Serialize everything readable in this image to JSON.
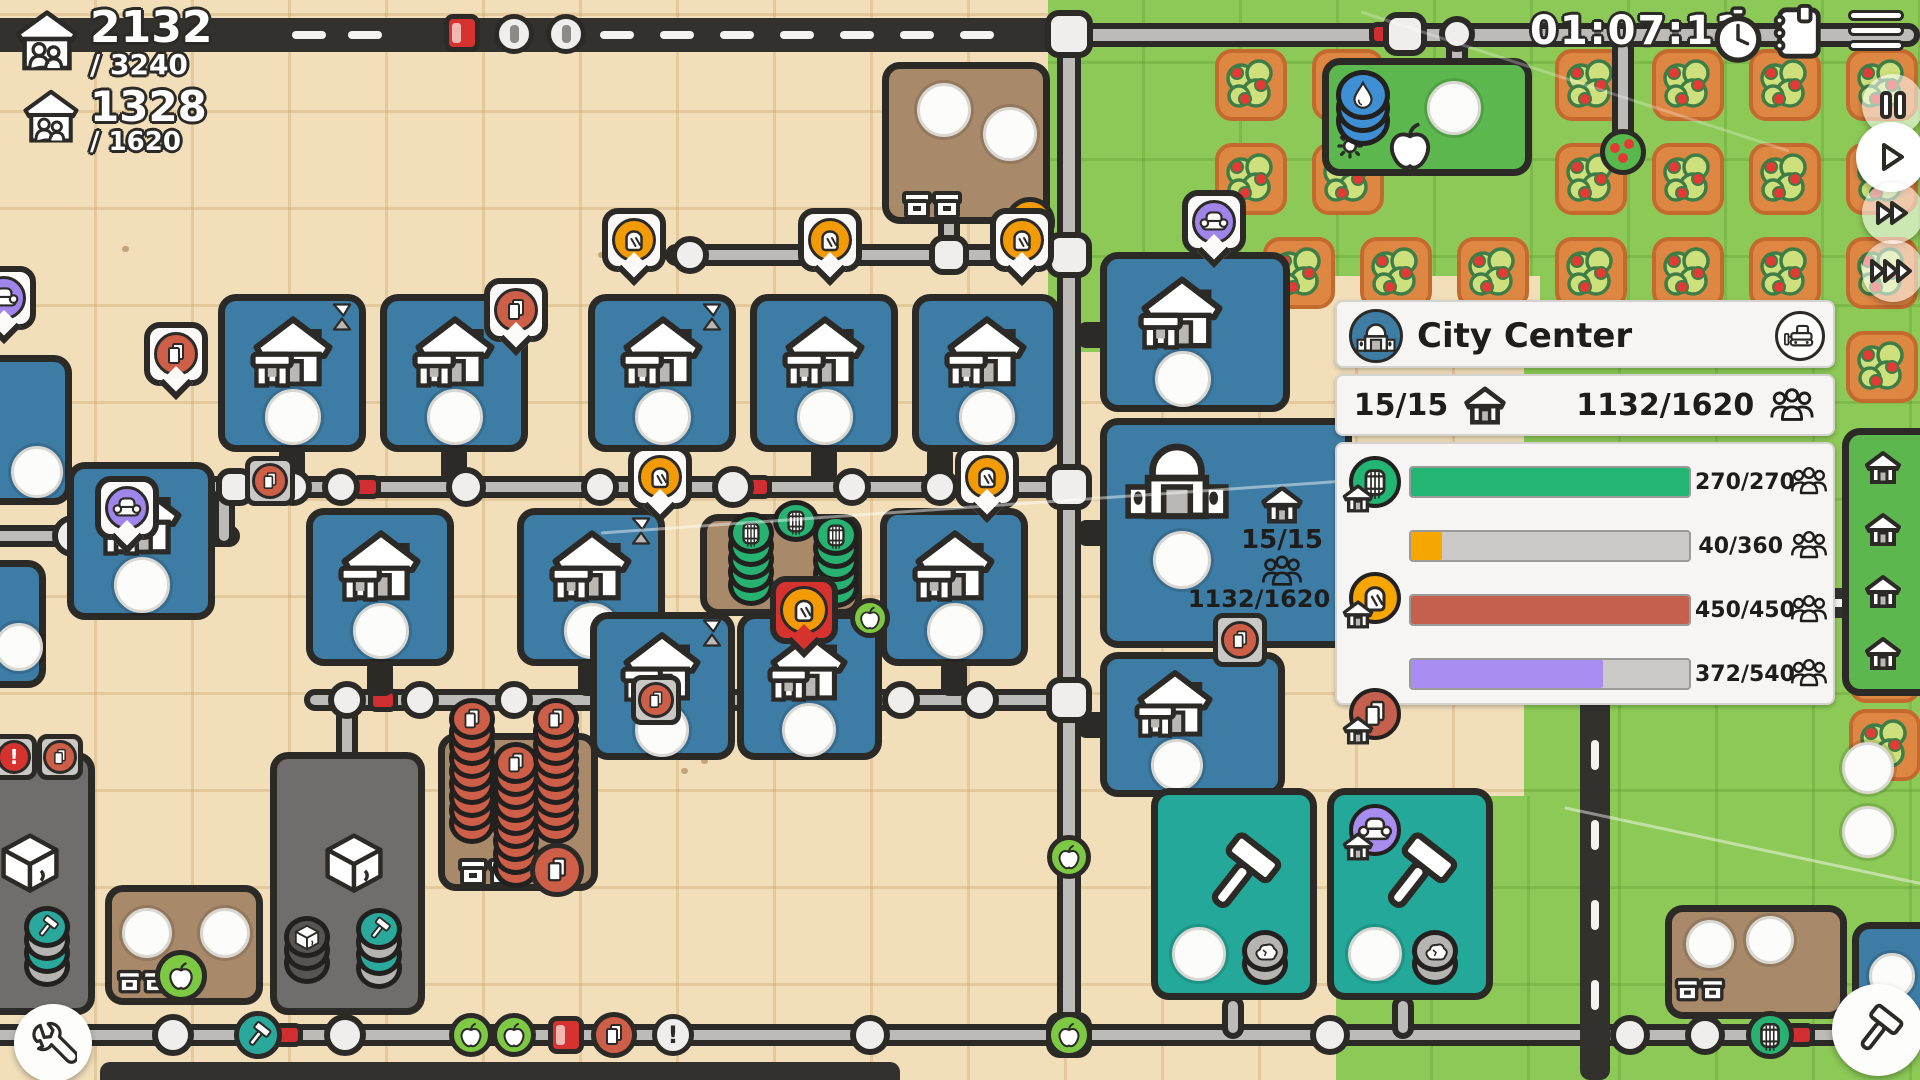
{
  "hud": {
    "population": {
      "value": "2132",
      "cap": "/ 3240"
    },
    "housing": {
      "value": "1328",
      "cap": "/ 1620"
    },
    "timer": "01:07:11"
  },
  "panel": {
    "title": "City Center",
    "stats": {
      "buildings": "15/15",
      "population": "1132/1620"
    },
    "needs": [
      {
        "resource": "barrel",
        "value": "270/270",
        "fill_pct": 100,
        "color": "#22b573"
      },
      {
        "resource": "bread",
        "value": "40/360",
        "fill_pct": 11,
        "color": "#f7a600"
      },
      {
        "resource": "paper",
        "value": "450/450",
        "fill_pct": 100,
        "color": "#c4604d"
      },
      {
        "resource": "couch",
        "value": "372/540",
        "fill_pct": 69,
        "color": "#a78df0"
      }
    ]
  },
  "map": {
    "city_center": {
      "buildings": "15/15",
      "population": "1132/1620"
    }
  },
  "badges": {
    "exclamation": "!"
  },
  "colors": {
    "tile_blue": "#3d7ca4",
    "tile_teal": "#23a89a",
    "tile_gray": "#6f6e6c",
    "tile_brown": "#a8896a",
    "tile_green": "#5cb84e",
    "barrel_green": "#27b271",
    "bread_orange": "#f29b05",
    "paper_red": "#cd5f49",
    "couch_purple": "#9f84ea",
    "water_blue": "#3f8fd4",
    "apple_green": "#7ec944",
    "selected_red": "#d6322f"
  },
  "icons": {
    "house": "housing building glyph",
    "people-group": "three person silhouettes",
    "timer-clock": "stopwatch",
    "notebook": "spiral notebook",
    "menu": "hamburger",
    "pause": "pause bars",
    "play": "play triangle",
    "fast-forward": "double triangle",
    "fastest-forward": "triple triangle",
    "city-center": "domed building",
    "bulldozer": "demolish bulldozer",
    "barrel": "barrel",
    "bread": "bread slice",
    "paper": "paper sheets",
    "couch": "armchair",
    "hammer": "mallet",
    "cube": "stone cube",
    "apple": "apple",
    "water-drop": "water drop",
    "wrench": "wrench",
    "rock": "stone",
    "hourglass": "hourglass",
    "gear": "gears",
    "bin": "storage bins",
    "exclamation": "alert"
  }
}
